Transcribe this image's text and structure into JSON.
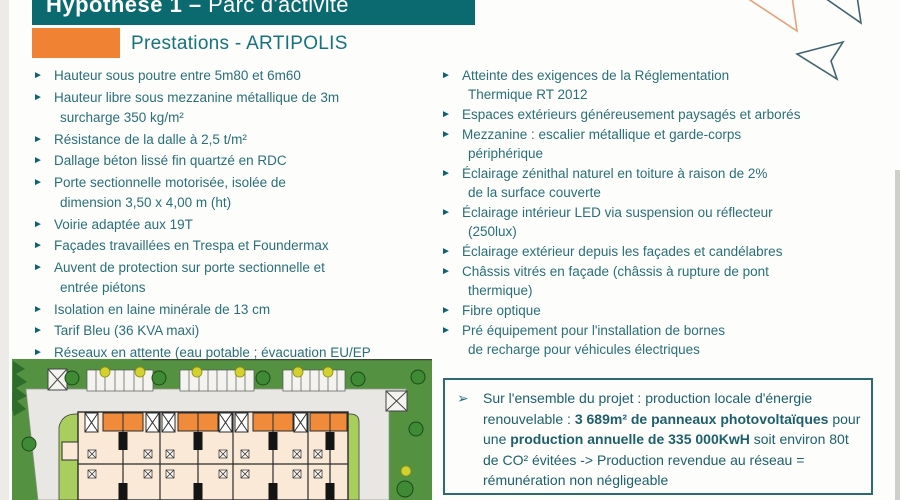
{
  "header": {
    "title_bold": "Hypothèse 1 –",
    "title_rest": " Parc d'activité",
    "subtitle": "Prestations - ARTIPOLIS"
  },
  "glyphs": {
    "bullet": "►",
    "callout_bullet": "➢"
  },
  "columns": {
    "left": {
      "items": [
        {
          "lines": [
            "Hauteur sous poutre entre 5m80 et 6m60"
          ]
        },
        {
          "lines": [
            "Hauteur libre sous mezzanine métallique de 3m",
            "surcharge 350 kg/m²"
          ]
        },
        {
          "lines": [
            "Résistance de la dalle à 2,5 t/m²"
          ]
        },
        {
          "lines": [
            "Dallage béton lissé fin quartzé en RDC"
          ]
        },
        {
          "lines": [
            "Porte sectionnelle motorisée, isolée de",
            "dimension 3,50 x 4,00 m (ht)"
          ]
        },
        {
          "lines": [
            "Voirie adaptée aux 19T"
          ]
        },
        {
          "lines": [
            "Façades travaillées en Trespa et Foundermax"
          ]
        },
        {
          "lines": [
            "Auvent de protection sur porte sectionnelle et",
            "entrée piétons"
          ]
        },
        {
          "lines": [
            "Isolation en laine minérale de 13 cm"
          ]
        },
        {
          "lines": [
            "Tarif Bleu (36 KVA maxi)"
          ]
        },
        {
          "lines": [
            "Réseaux en attente (eau potable ; évacuation EU/EP",
            "et réseau sec) disponibles dans chaque lot"
          ]
        }
      ]
    },
    "right": {
      "items": [
        {
          "lines": [
            "Atteinte des exigences de la Réglementation",
            "Thermique RT 2012"
          ]
        },
        {
          "lines": [
            "Espaces extérieurs généreusement paysagés et arborés"
          ]
        },
        {
          "lines": [
            "Mezzanine : escalier métallique et garde-corps",
            "périphérique"
          ]
        },
        {
          "lines": [
            "Éclairage zénithal naturel en toiture à raison de 2%",
            "de la surface couverte"
          ]
        },
        {
          "lines": [
            "Éclairage intérieur LED via suspension ou réflecteur",
            "(250lux)"
          ]
        },
        {
          "lines": [
            "Éclairage extérieur depuis les façades et candélabres"
          ]
        },
        {
          "lines": [
            "Châssis vitrés en façade (châssis à rupture de pont",
            "thermique)"
          ]
        },
        {
          "lines": [
            "Fibre optique"
          ]
        },
        {
          "lines": [
            "Pré équipement pour l'installation de bornes",
            "de recharge pour véhicules électriques"
          ]
        }
      ]
    }
  },
  "callout": {
    "segments": [
      {
        "text": "Sur l'ensemble du projet : production locale d'énergie renouvelable : ",
        "bold": false
      },
      {
        "text": "3 689m² de panneaux photovoltaïques",
        "bold": true
      },
      {
        "text": " pour une ",
        "bold": false
      },
      {
        "text": "production annuelle de 335 000KwH",
        "bold": true
      },
      {
        "text": " soit environ 80t de CO² évitées -> Production revendue au réseau = rémunération non négligeable",
        "bold": false
      }
    ]
  },
  "colors": {
    "banner_teal": "#0b6a70",
    "accent_orange": "#f08233",
    "text_teal": "#2a6f77",
    "callout_border": "#2e6a72",
    "plan_dark_green": "#549140",
    "plan_light_green": "#a8cf5e",
    "plan_building": "#fbe9d8",
    "plan_mezzanine_orange": "#ef8b3b"
  }
}
